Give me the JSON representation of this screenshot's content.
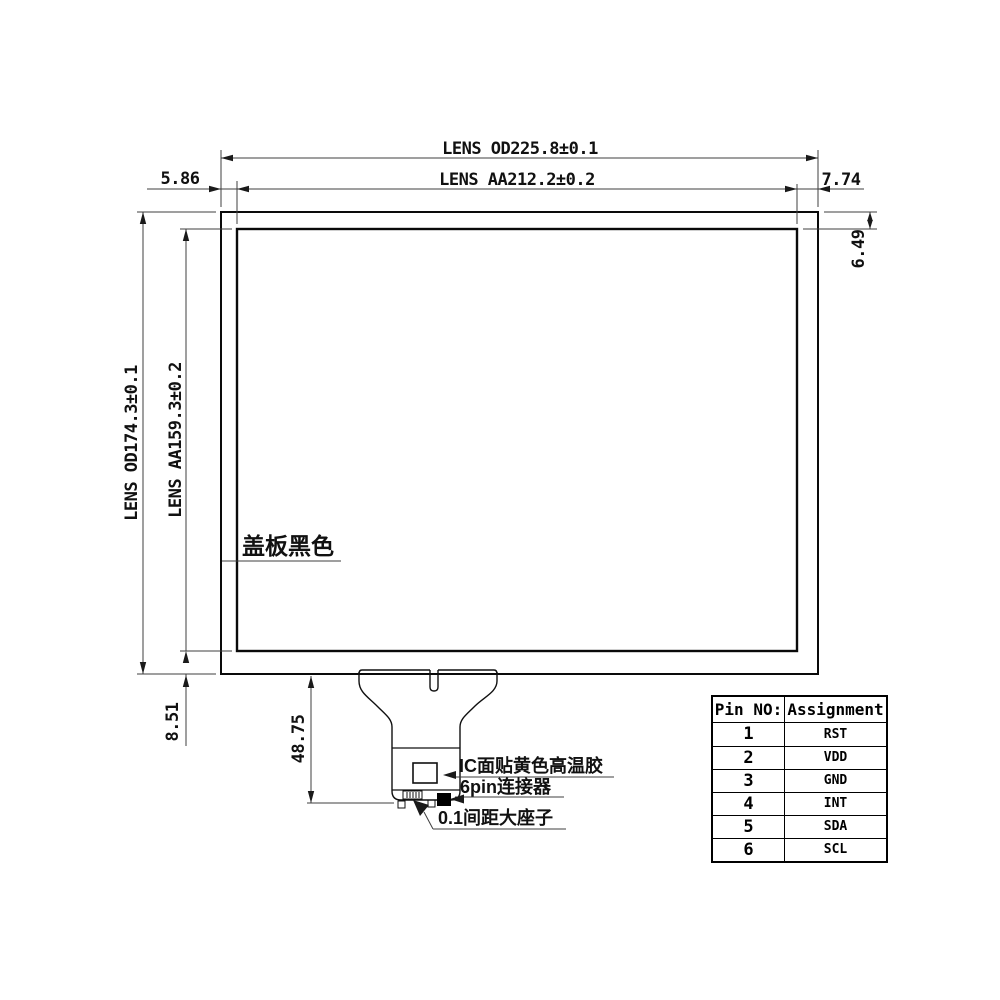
{
  "drawing": {
    "top": {
      "od_label": "LENS OD225.8±0.1",
      "aa_label": "LENS AA212.2±0.2",
      "left_margin": "5.86",
      "right_margin": "7.74"
    },
    "left": {
      "od_label": "LENS OD174.3±0.1",
      "aa_label": "LENS AA159.3±0.2"
    },
    "right": {
      "top_margin": "6.49"
    },
    "bottom": {
      "bottom_margin": "8.51",
      "tail_length": "48.75"
    },
    "callouts": {
      "cover_black": "盖板黑色",
      "ic_tape": "IC面贴黄色高温胶",
      "connector_6pin": "6pin连接器",
      "pitch_socket": "0.1间距大座子"
    }
  },
  "pin_table": {
    "headers": [
      "Pin NO:",
      "Assignment"
    ],
    "rows": [
      {
        "pin": "1",
        "assignment": "RST"
      },
      {
        "pin": "2",
        "assignment": "VDD"
      },
      {
        "pin": "3",
        "assignment": "GND"
      },
      {
        "pin": "4",
        "assignment": "INT"
      },
      {
        "pin": "5",
        "assignment": "SDA"
      },
      {
        "pin": "6",
        "assignment": "SCL"
      }
    ]
  },
  "colors": {
    "line": "#000000",
    "dim_line": "#3f3f3f",
    "background": "#ffffff"
  }
}
